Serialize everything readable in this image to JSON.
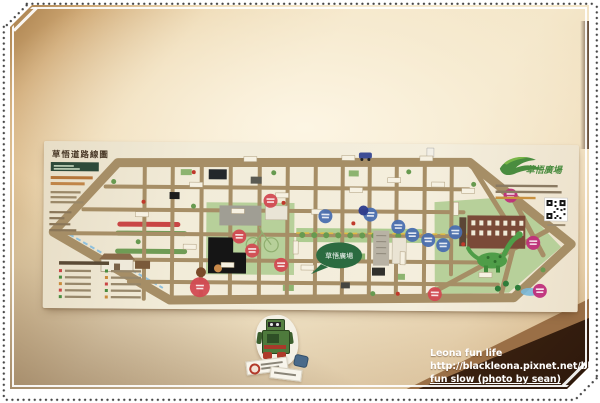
{
  "photo": {
    "watermark": {
      "line1": "Leona fun life",
      "line2": "http://blackleona.pixnet.net/blog",
      "line3": "fun slow (photo by sean)"
    }
  },
  "map_poster": {
    "title": "草悟道路線圖",
    "brand": "草悟廣場",
    "center_plaza_label": "草悟廣場",
    "colors": {
      "road": "#a68e66",
      "park": "#b7d09a",
      "red": "#d24a52",
      "blue": "#4a6fb0",
      "navy": "#2b3a8c",
      "magenta": "#bf2f7b",
      "brand_green": "#4a8c3f"
    },
    "markers": [
      {
        "x": 227,
        "y": 58,
        "c": "red"
      },
      {
        "x": 196,
        "y": 94,
        "c": "red"
      },
      {
        "x": 209,
        "y": 108,
        "c": "red"
      },
      {
        "x": 238,
        "y": 122,
        "c": "red"
      },
      {
        "x": 157,
        "y": 145,
        "c": "red",
        "r": 10
      },
      {
        "x": 392,
        "y": 150,
        "c": "red"
      },
      {
        "x": 282,
        "y": 73,
        "c": "blue"
      },
      {
        "x": 327,
        "y": 71,
        "c": "blue"
      },
      {
        "x": 355,
        "y": 83,
        "c": "blue"
      },
      {
        "x": 369,
        "y": 91,
        "c": "blue"
      },
      {
        "x": 385,
        "y": 96,
        "c": "blue"
      },
      {
        "x": 400,
        "y": 101,
        "c": "blue"
      },
      {
        "x": 412,
        "y": 88,
        "c": "blue"
      },
      {
        "x": 320,
        "y": 67,
        "c": "navy",
        "r": 5
      },
      {
        "x": 467,
        "y": 51,
        "c": "magenta"
      },
      {
        "x": 490,
        "y": 98,
        "c": "magenta"
      },
      {
        "x": 497,
        "y": 146,
        "c": "magenta"
      }
    ]
  }
}
